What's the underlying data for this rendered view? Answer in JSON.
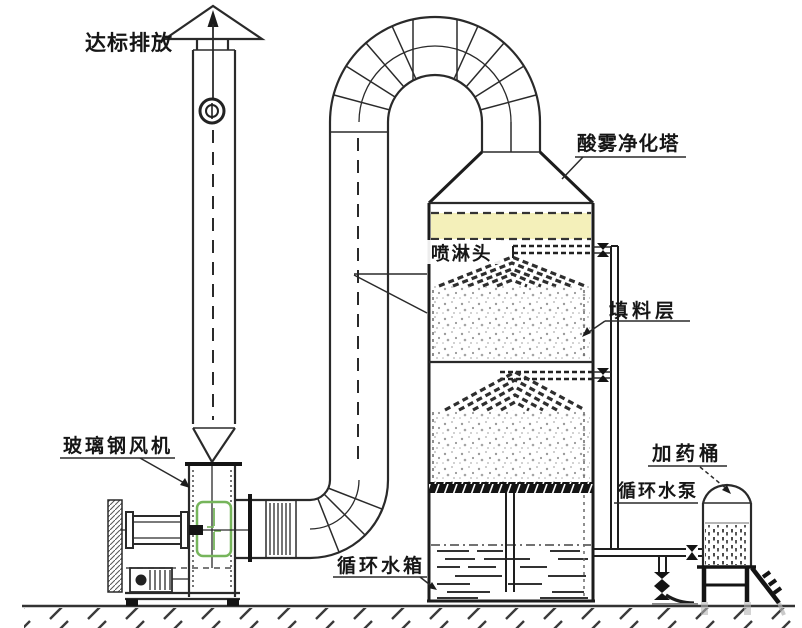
{
  "diagram": {
    "background": "#ffffff",
    "line_color": "#2a2a2a",
    "demister_color": "#f4f0ba",
    "highlight_color": "#76b55b",
    "labels": {
      "discharge": "达标排放",
      "tower": "酸雾净化塔",
      "spray_head": "喷淋头",
      "packing_layer": "填料层",
      "fan": "玻璃钢风机",
      "water_tank": "循环水箱",
      "water_pump": "循环水泵",
      "dosing_barrel": "加药桶"
    }
  }
}
